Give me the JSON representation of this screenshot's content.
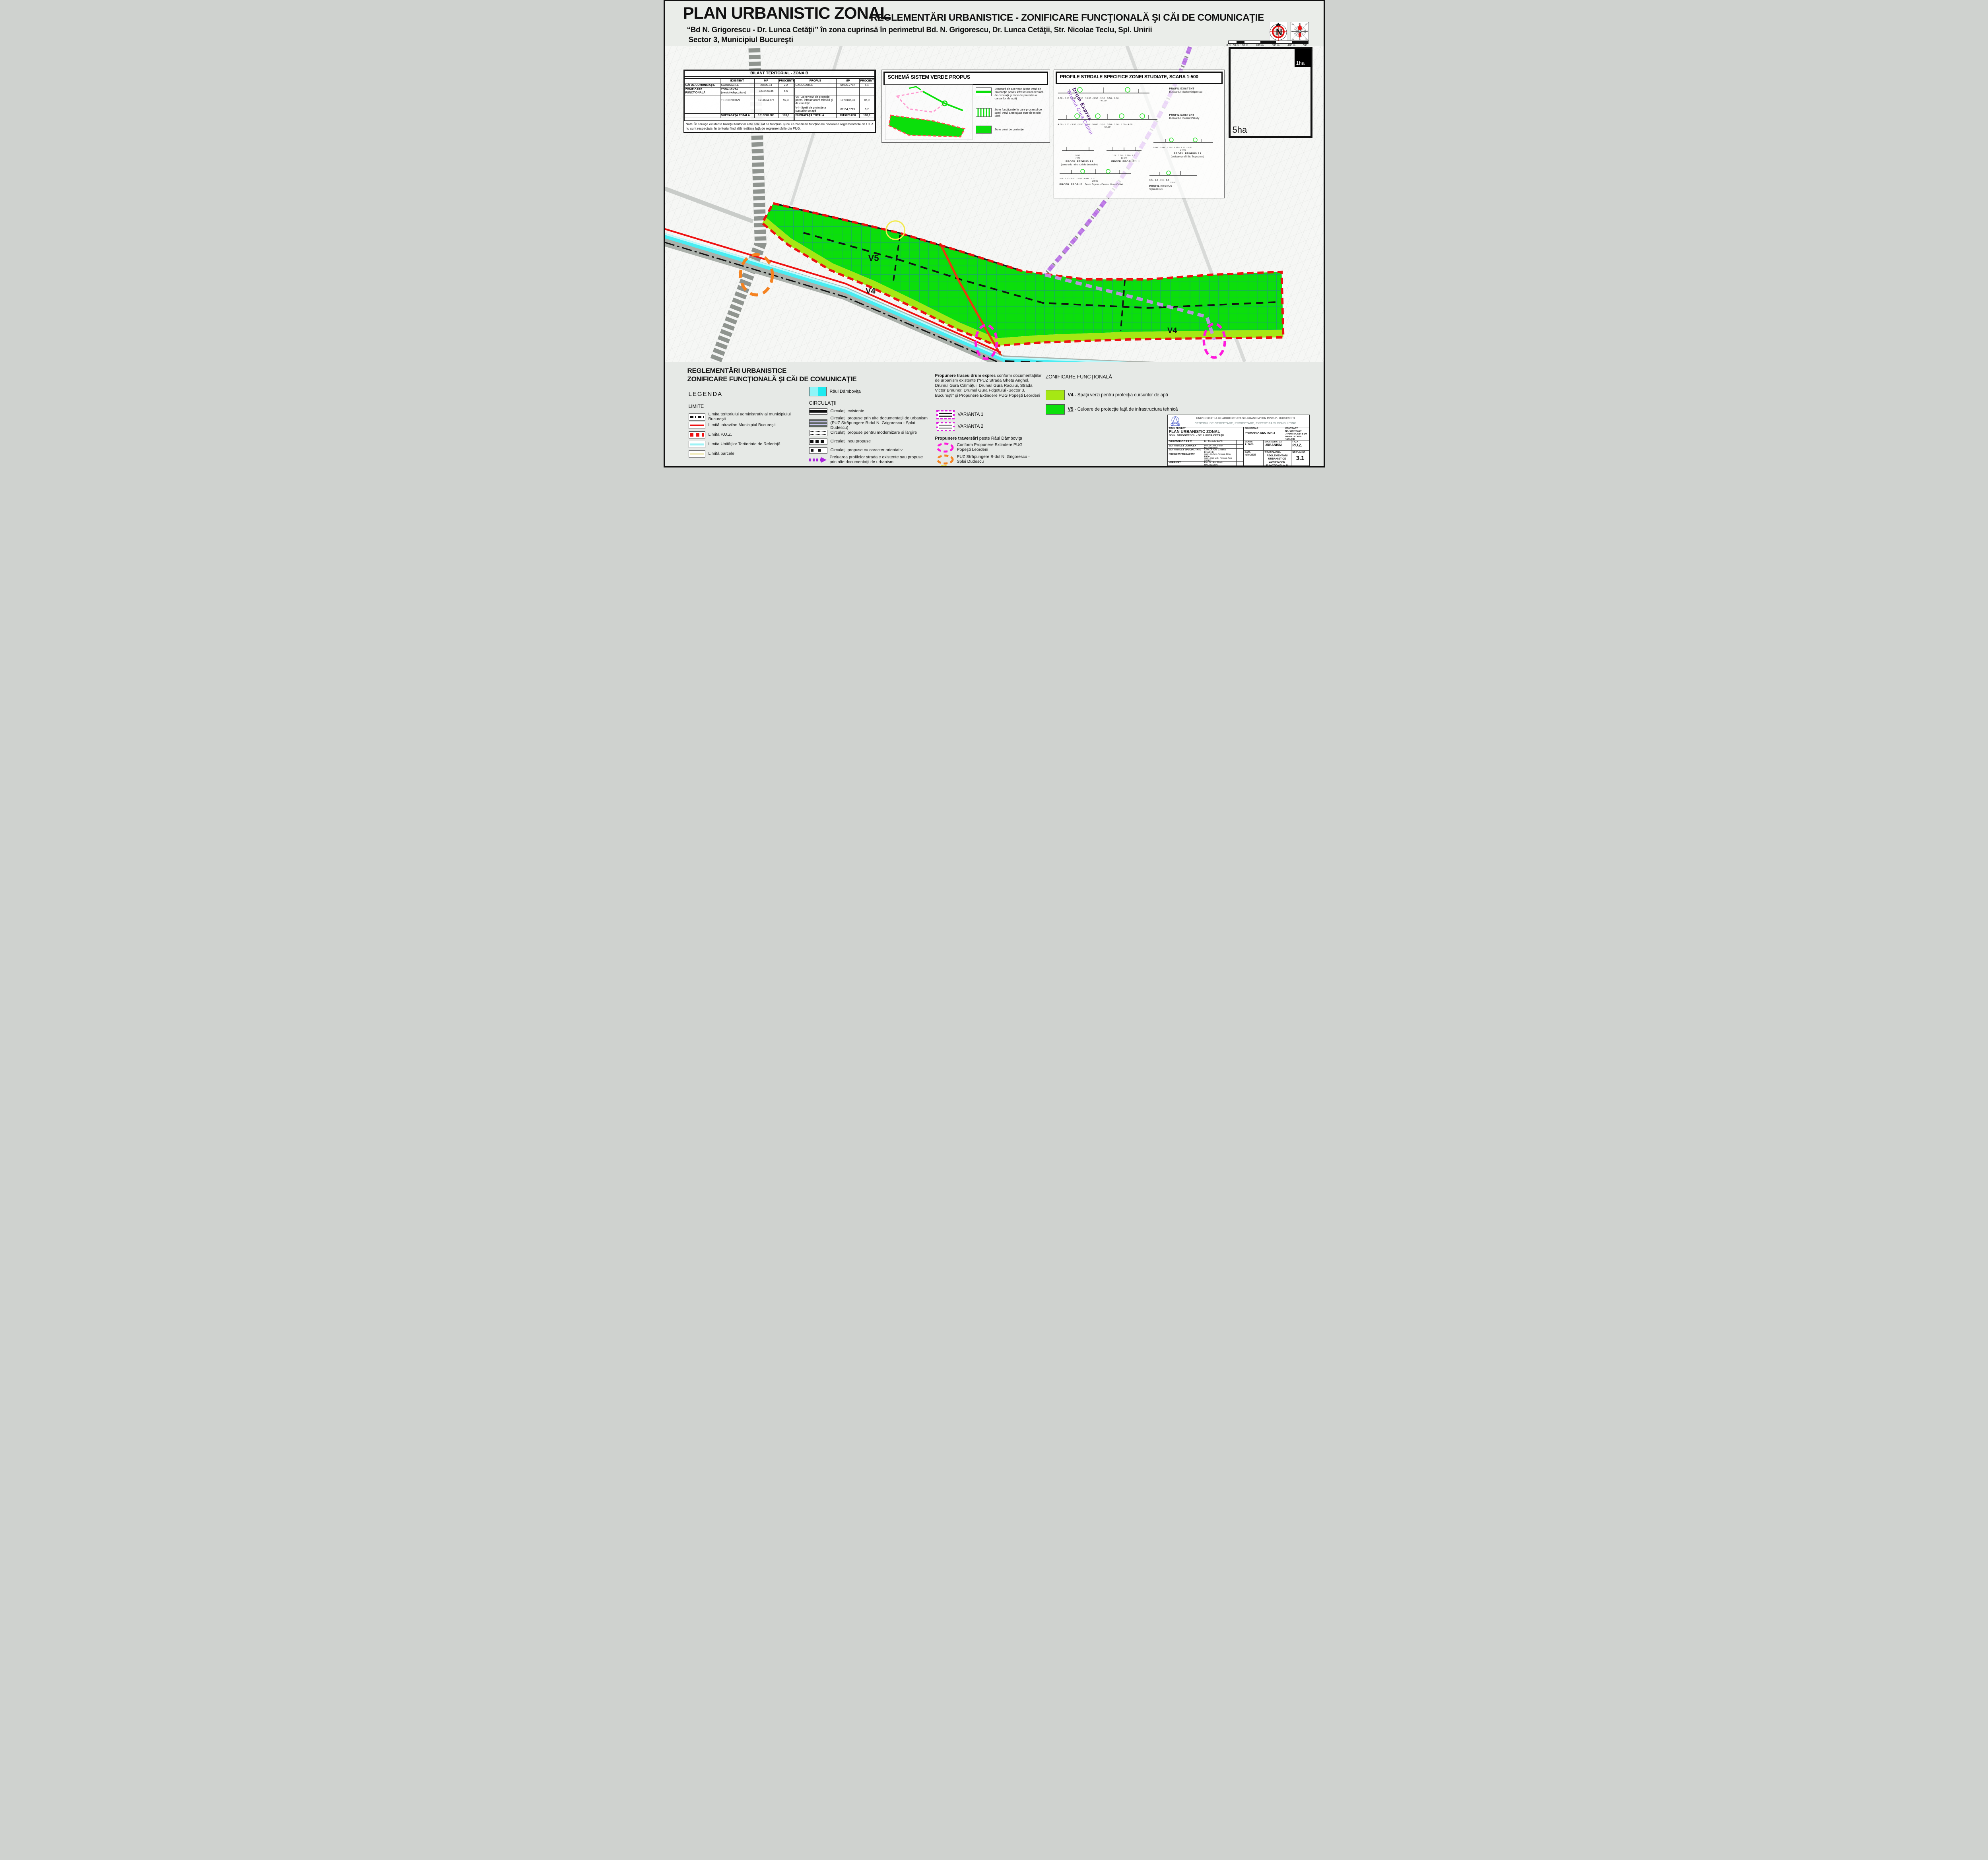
{
  "header": {
    "title": "PLAN URBANISTIC ZONAL",
    "title2": "REGLEMENTĂRI URBANISTICE - ZONIFICARE FUNCŢIONALĂ ŞI CĂI DE COMUNICAŢIE",
    "subtitle1": "“Bd N. Grigorescu - Dr. Lunca Cetăţii” în zona cuprinsă în perimetrul Bd. N. Grigorescu, Dr. Lunca Cetăţii, Str. Nicolae Teclu, Spl. Unirii",
    "subtitle2": "Sector 3, Municipiul Bucureşti",
    "compass_n": "N",
    "windrose": {
      "n": "N",
      "ne": "NE",
      "e": "E",
      "se": "SE",
      "s": "S",
      "sv": "SV",
      "v": "V",
      "nv": "NV",
      "center": "12"
    },
    "scalebar_labels": [
      "0 m",
      "50 m",
      "100 m",
      "200 m",
      "300 m",
      "400 m",
      "500 m"
    ]
  },
  "bilant": {
    "title": "BILANT TERITORIAL - ZONA B",
    "h_existent": "EXISTENT",
    "h_mp1": "MP",
    "h_proc1": "PROCENTE",
    "h_propus": "PROPUS",
    "h_mp2": "MP",
    "h_proc2": "PROCENTE",
    "rows": [
      {
        "cat": "CĂI DE COMUNICAŢIE",
        "e_name": "CAROSABILE",
        "e_mp": "28890,84",
        "e_pc": "2,2",
        "p_name": "CAROSABILE",
        "p_mp": "66039,2787",
        "p_pc": "5,4"
      },
      {
        "cat": "ZONIFICARE FUNCTIONALĂ",
        "e_name": "ZONĂ MIXTĂ (servicii+depozitare)",
        "e_mp": "72724,5835",
        "e_pc": "5,5",
        "p_name": "",
        "p_mp": "",
        "p_pc": ""
      },
      {
        "cat": "",
        "e_name": "TEREN VIRAN",
        "e_mp": "1211604,577",
        "e_pc": "92,3",
        "p_name": "V5 - Zone verzi de protecţie pentru infrastructura tehnică şi de circulaţie",
        "p_mp": "1070187,35",
        "p_pc": "87,9"
      },
      {
        "cat": "",
        "e_name": "",
        "e_mp": "",
        "e_pc": "",
        "p_name": "V4 - Spaţii de protecţie a cursurilor de apă",
        "p_mp": "81164,5719",
        "p_pc": "6,7"
      },
      {
        "cat": "",
        "e_name": "SUPRAFAŢĂ TOTALĂ",
        "e_mp": "1313220.000",
        "e_pc": "100,0",
        "p_name": "SUPRAFAŢĂ TOTALĂ",
        "p_mp": "1313220.000",
        "p_pc": "100,0"
      }
    ],
    "note": "Notă: În situaţia existentă bilanţul teritorial este calculat ca funcţiuni şi nu ca zonificări funcţionale deoarece reglementările de UTR nu sunt respectate, în teritoriu fiind altă realitate faţă de reglementările din PUG."
  },
  "schema": {
    "title": "SCHEMĂ SISTEM VERDE PROPUS",
    "legend1": "Structură de axe verzi (zone verzi de protencţie pentru infrastructura tehnică, de circulaţii şi zone de protecţia a cursurilor de apă)",
    "legend2": "Zone funcţionale în care procentul de spaţii verzi amenajate este de minim 30%",
    "legend3": "Zone verzi de protecţie"
  },
  "profiles": {
    "title": "PROFILE STRDALE SPECIFICE ZONEI STUDIATE, SCARA 1:500",
    "items": [
      {
        "name": "PROFIL EXISTENT",
        "sub": "Bulevardul Nicolae Grigorescu",
        "dims": "6.00 · 3.50 · 3.50 · 3.50 · 10.00 · 3.50 · 3.50 · 3.50 · 6.00",
        "total": "47.00"
      },
      {
        "name": "PROFIL EXISTENT",
        "sub": "Bulevardul Theodor Pallady",
        "dims": "4.00 · 5.00 · 3.50 · 3.50 · 3.50 · 10.00 · 3.50 · 3.50 · 3.50 · 5.00 · 4.00",
        "total": "57.00"
      },
      {
        "name": "PROFIL PROPUS 1.I",
        "sub": "(sens unic - drumuri de deservire)",
        "dims": "5.00",
        "total": "7.00"
      },
      {
        "name": "PROFIL PROPUS 1.II",
        "sub": "",
        "dims": "1.5 · 3.50 · 3.50 · 1.5",
        "total": "10.00"
      },
      {
        "name": "PROFIL PROPUS 2.I",
        "sub": "(preluare profil Str. Trapezului)",
        "dims": "5.00 · 3.50 · 3.50 · 3.50 · 3.50 · 5.00",
        "total": "24.00"
      },
      {
        "name": "PROFIL PROPUS",
        "sub": "Drum Expres - Drumul Gura Calitei",
        "dims": "3.0 · 2.0 · 3.50 · 3.50 · 4.00 · 2.0",
        "total": "28.00"
      },
      {
        "name": "PROFIL PROPUS",
        "sub": "Splaiul Unirii",
        "dims": "3.5 · 1.5 · 2.0 · 2.5",
        "total": "23.50"
      }
    ],
    "corridor_label1": "Drum Expres",
    "corridor_label2": "Drumul Gura Calitei"
  },
  "map": {
    "v5_label": "V5",
    "v4_label": "V4",
    "v4_label2": "V4",
    "ha1": "1ha",
    "ha5": "5ha"
  },
  "legend": {
    "heading1": "REGLEMENTĂRI URBANISTICE",
    "heading2": "ZONIFICARE FUNCŢIONALĂ ŞI CĂI DE COMUNICAŢIE",
    "legenda": "LEGENDA",
    "limite_title": "LIMITE",
    "limite": [
      "Limita teritoriului administrativ al municipiului Bucureşti",
      "Limită intravilan Municipiul Bucureşti",
      "Limita P.U.Z.",
      "Limita Unităţilor Teritoriate de Referinţă",
      "Limită parcele"
    ],
    "raul": "Râul Dâmboviţa",
    "circulatii_title": "CIRCULAŢII",
    "circulatii": [
      "Circulaţii existente",
      "Circulaţii propuse prin alte documentaţii de urbanism (PUZ Străpungere B-dul N. Grigorescu - Splai Dudescu)",
      "Circulaţii propuse pentru modernizare si lărgire",
      "Circulaţii nou propuse",
      "Circulaţii propuse cu caracter orientativ",
      "Preluarea profilelor stradale existente sau propuse prin alte documentaţii de urbanism"
    ],
    "propunere_bold": "Propunere traseu drum expres",
    "propunere_rest": " conform documentaţiilor de urbanism existente (\"PUZ Strada Ghetu Anghel, Drumul Gura Călmăţui, Drumul Gura Racului, Strada Victor Brauner, Drumul Gura Fdgetului -Sector 3, Bucureşti\" şi Propunere Extindere PUG Popeşti Leordeni",
    "varianta1": "VARIANTA 1",
    "varianta2": "VARIANTA 2",
    "traversari_bold": "Propunere traversări",
    "traversari_rest": " peste Râul Dâmboviţa",
    "traversari1": "Conform Propunere Extindere PUG Popeşti Leordeni",
    "traversari2": "PUZ Străpungere B-dul N. Grigorescu - Splai Dudescu",
    "traversari3": "Intersecţii ce necesită sistematizare",
    "zonificare_title": "ZONIFICARE FUNCŢIONALĂ",
    "v4_code": "V4",
    "v4_text": " - Spaţii verzi pentru protecţia cursurilor de apă",
    "v5_code": "V5",
    "v5_text": " - Culoare de protecţie faţă de infrastructura tehnică"
  },
  "titleblock": {
    "uni1": "UNIVERSITATEA DE ARHITECTURA SI URBANISM \"ION MINCU\" - BUCURESTI",
    "uni2": "CENTRUL DE CERCETARE, PROIECTARE, EXPERTIZA SI CONSULTING",
    "titlu_proiect_label": "TITLU PROIECT",
    "titlu_proiect1": "PLAN URBANISTIC ZONAL",
    "titlu_proiect2": "BD N. GRIGORESCU - DR. LUNCA CETĂŢII",
    "beneficiar_label": "BENEFICIAR",
    "beneficiar": "PRIMARIA SECTOR 3",
    "contract_label": "CONTRACT",
    "contract": "NR. CONTRACT 7073/07.07.2014 B (nr. UAUIM - CCPEC  4/2014 B)",
    "rows": [
      {
        "label": "DIRECTOR   C.C.P.E.C.",
        "name": "Ec. Daniela RACU"
      },
      {
        "label": "SEF PROIECT COMPLEX",
        "name": "Prof.Dr. Arh.  Florin MACHEDON"
      },
      {
        "label": "SEF PROIECT SPECIALITATE",
        "name": "Conf.Dr. Arh.  Cristina ENACHE"
      },
      {
        "label": "PROIECTAT/REDACTAT",
        "name": "Asist.Dr. Urb.Peisag.  Irina PATA"
      },
      {
        "label": "",
        "name": "Asist.Drd. Urb. Peisag.  Ana OPRIS"
      },
      {
        "label": "VERIFICAT",
        "name": "Prof.Dr. Arh.  Florin MACHEDON"
      }
    ],
    "scara_label": "SCARA",
    "scara": "1: 5000",
    "data_label": "DATA",
    "data": "iulie 2015",
    "spec_label": "SPECIALITATEA",
    "spec": "URBANISM",
    "faza_label": "FAZA",
    "faza": "P.U.Z.",
    "titlu_plansa_label": "TITLU PLANSA",
    "titlu_plansa": "REGLEMENTĂRI URBANISTICE ZONIFICARE FUNCTIONALĂ ŞI CĂI DE COMUNICAŢIE",
    "nr_plansa_label": "NR.PLANSA",
    "nr_plansa": "3.1"
  },
  "colors": {
    "v4": "#a6e714",
    "v5": "#0bdf0b",
    "river": "#55eef2",
    "puz_red": "#ee1111",
    "orange": "#f58220",
    "magenta": "#ff1adc",
    "purple": "#b76ae6",
    "yellow": "#f2ea4d"
  }
}
